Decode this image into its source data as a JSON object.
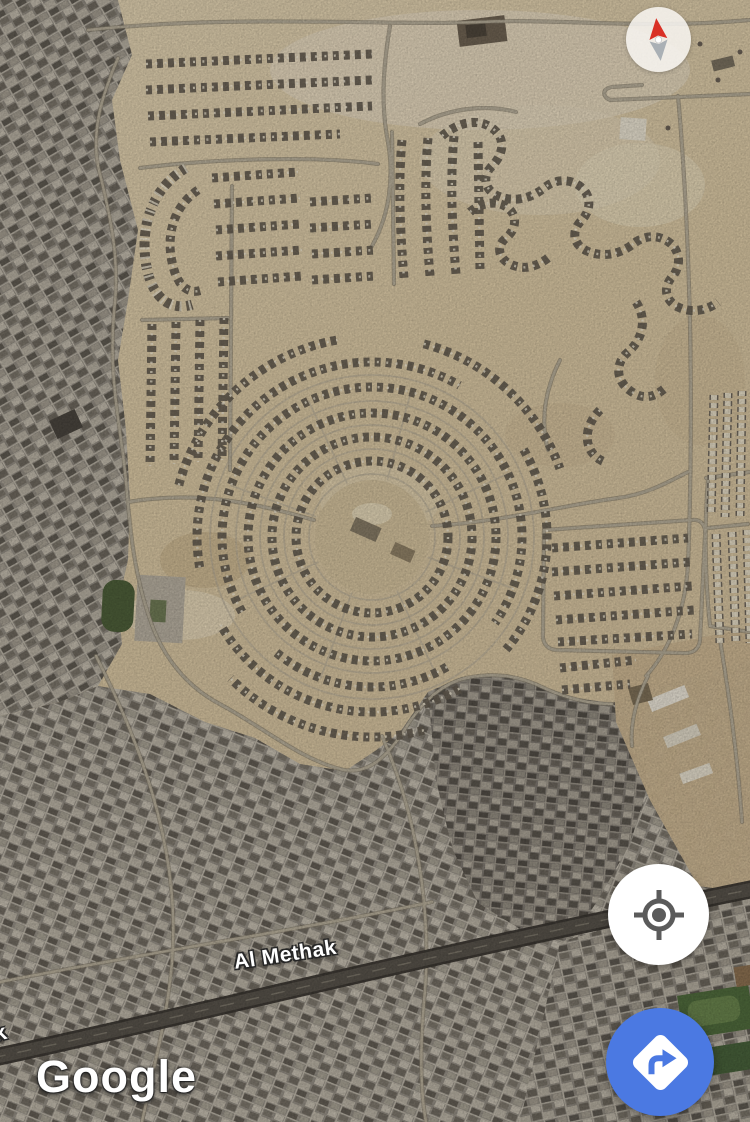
{
  "map": {
    "view_type": "satellite",
    "road_labels": {
      "primary": "Al Methak",
      "truncated_left": "k"
    },
    "attribution": {
      "logo_text": "Google"
    }
  },
  "controls": {
    "compass": {
      "icon": "compass-icon",
      "needle_north_color": "#d93025",
      "needle_south_color": "#aab0b5"
    },
    "my_location": {
      "icon": "my-location-icon",
      "icon_color": "#5b5b5b"
    },
    "directions": {
      "icon": "directions-icon",
      "background_color": "#4b79e2"
    }
  },
  "colors": {
    "desert": "#d9c8a6",
    "desert_light": "#e6dabd",
    "city_block_grey": "#918b81",
    "house_row_dark": "#645c50",
    "road_minor": "#b7ae9a",
    "road_major_dark": "#57524a",
    "field_green": "#4f6a3c",
    "accent_blue": "#4b79e2",
    "label_white": "#ffffff"
  }
}
